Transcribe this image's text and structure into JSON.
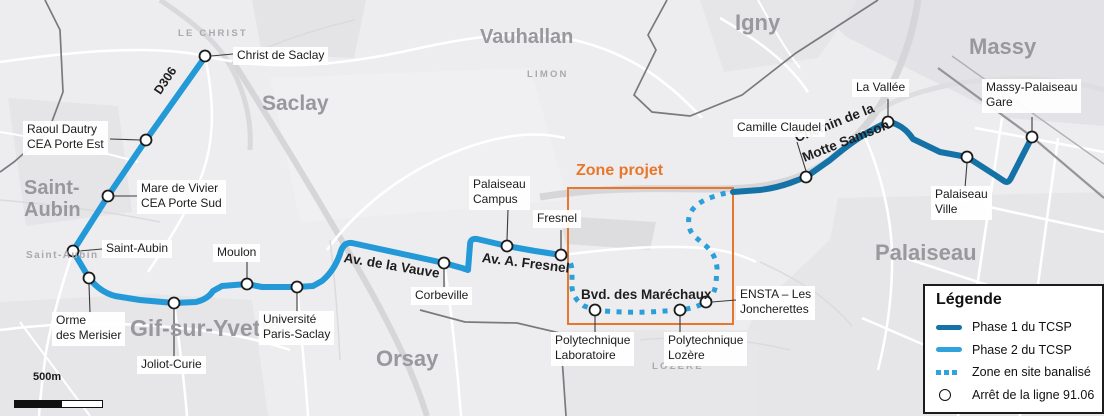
{
  "map": {
    "zone_label": "Zone projet",
    "scale_label": "500m"
  },
  "colors": {
    "phase1_blue": "#1572A7",
    "phase2_blue": "#2399D8",
    "dotted_blue": "#2B9FD9",
    "zone_orange": "#E8772B"
  },
  "places": {
    "le_christ": "LE CHRIST",
    "saclay": "Saclay",
    "saint_aubin": {
      "lines": [
        "Saint-",
        "Aubin"
      ]
    },
    "saint_aubin_small": "Saint-Aubin",
    "gif_sur_yvette": "Gif-sur-Yvette",
    "orsay": "Orsay",
    "vauhallan": "Vauhallan",
    "limon": "LIMON",
    "lozere": "LOZÈRE",
    "igny": "Igny",
    "massy": "Massy",
    "palaiseau": "Palaiseau"
  },
  "streets": {
    "d306": "D306",
    "av_de_la_vauve": "Av. de la Vauve",
    "av_a_fresnel": "Av. A. Fresnel",
    "bvd_des_marechaux": "Bvd. des Maréchaux",
    "chemin_motte": {
      "lines": [
        "Chemin de la",
        "Motte Samson"
      ]
    }
  },
  "stops": {
    "christ_de_saclay": {
      "lines": [
        "Christ de Saclay"
      ]
    },
    "raoul_dautry": {
      "lines": [
        "Raoul Dautry",
        "CEA Porte Est"
      ]
    },
    "mare_de_vivier": {
      "lines": [
        "Mare de Vivier",
        "CEA Porte Sud"
      ]
    },
    "saint_aubin": {
      "lines": [
        "Saint-Aubin"
      ]
    },
    "orme_des_merisier": {
      "lines": [
        "Orme",
        "des Merisier"
      ]
    },
    "joliot_curie": {
      "lines": [
        "Joliot-Curie"
      ]
    },
    "moulon": {
      "lines": [
        "Moulon"
      ]
    },
    "universite_paris_saclay": {
      "lines": [
        "Université",
        "Paris-Saclay"
      ]
    },
    "corbeville": {
      "lines": [
        "Corbeville"
      ]
    },
    "palaiseau_campus": {
      "lines": [
        "Palaiseau",
        "Campus"
      ]
    },
    "fresnel": {
      "lines": [
        "Fresnel"
      ]
    },
    "polytechnique_laboratoire": {
      "lines": [
        "Polytechnique",
        "Laboratoire"
      ]
    },
    "polytechnique_lozere": {
      "lines": [
        "Polytechnique",
        "Lozère"
      ]
    },
    "ensta_joncherettes": {
      "lines": [
        "ENSTA – Les",
        "Joncherettes"
      ]
    },
    "camille_claudel": {
      "lines": [
        "Camille Claudel"
      ]
    },
    "la_vallee": {
      "lines": [
        "La Vallée"
      ]
    },
    "massy_palaiseau_gare": {
      "lines": [
        "Massy-Palaiseau",
        "Gare"
      ]
    },
    "palaiseau_ville": {
      "lines": [
        "Palaiseau",
        "Ville"
      ]
    }
  },
  "legend": {
    "title": "Légende",
    "items": [
      {
        "label": "Phase 1 du TCSP"
      },
      {
        "label": "Phase 2 du TCSP"
      },
      {
        "label": "Zone en site banalisé"
      },
      {
        "label": "Arrêt de la ligne 91.06"
      }
    ]
  }
}
